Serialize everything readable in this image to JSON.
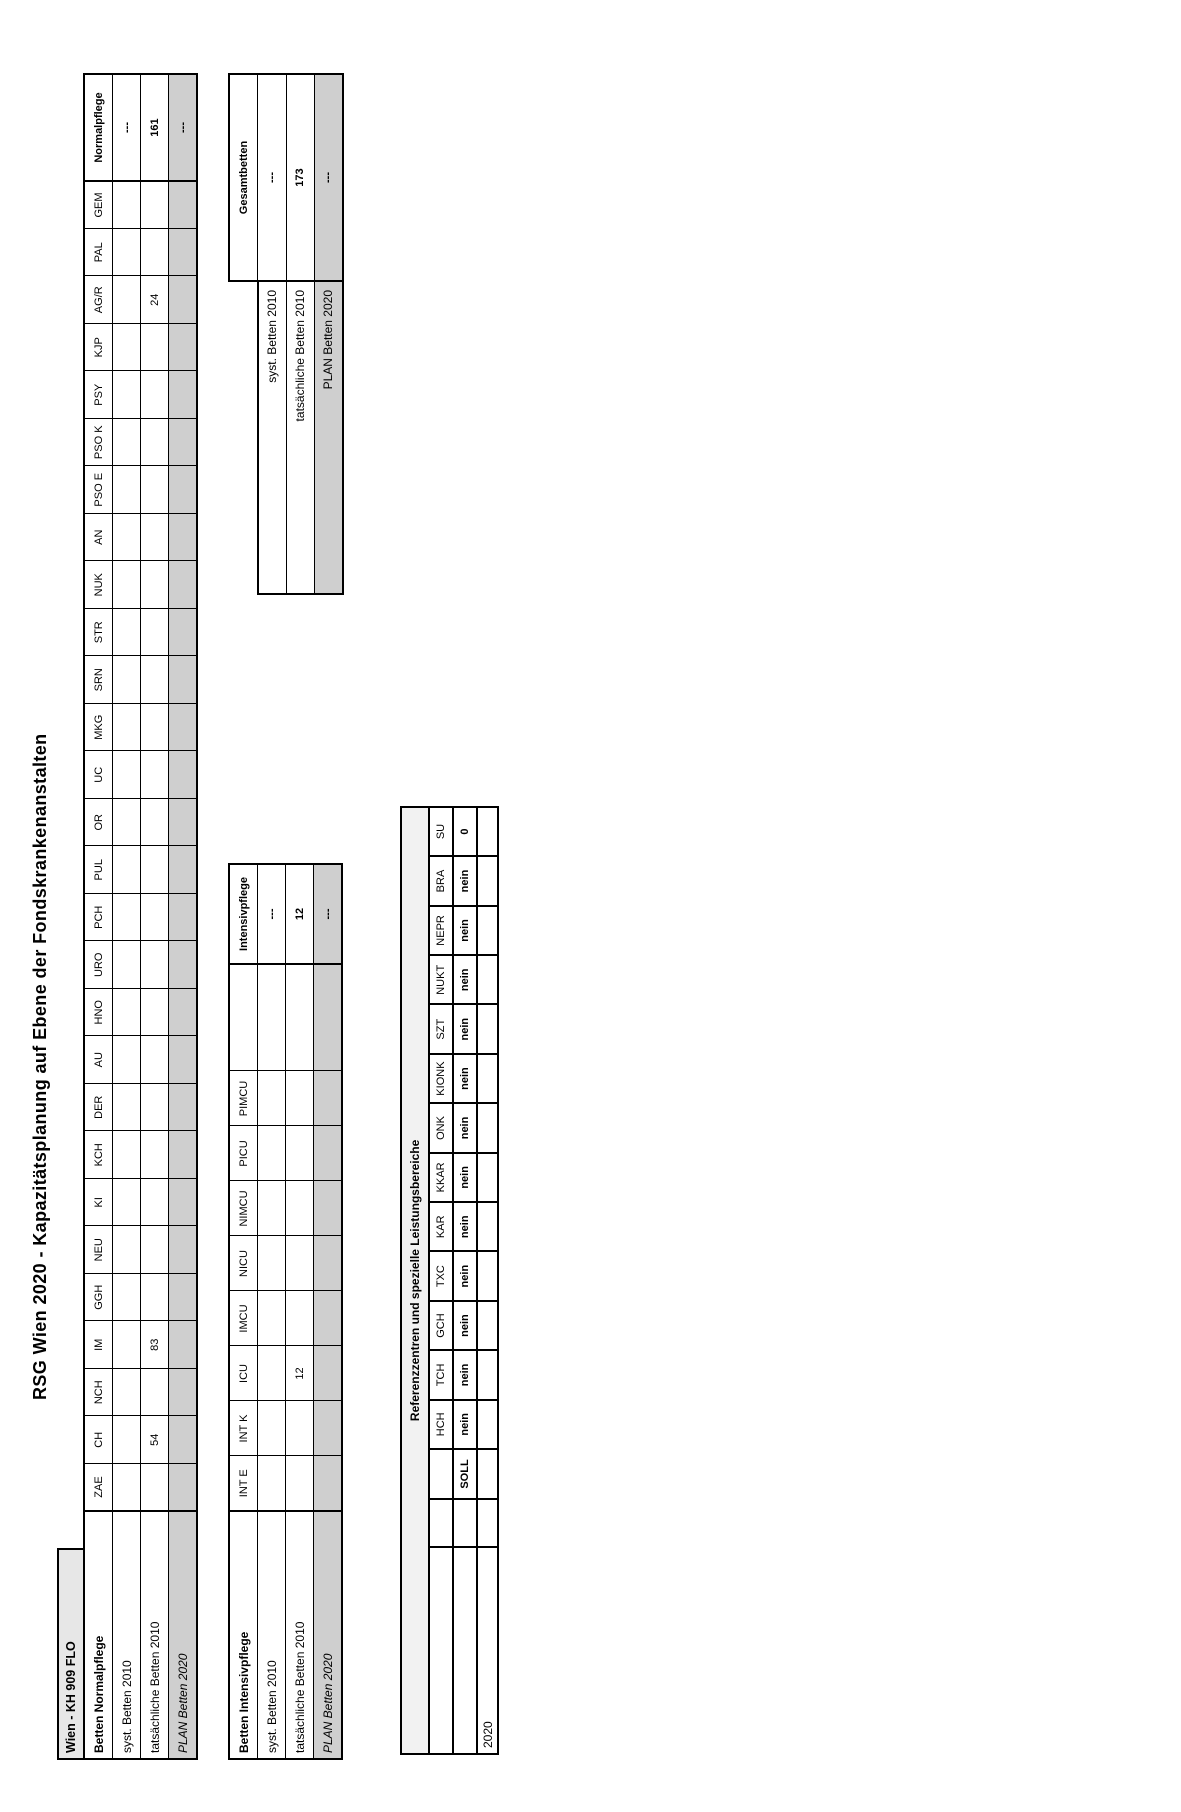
{
  "title": "RSG Wien 2020 - Kapazitätsplanung auf Ebene der Fondskrankenanstalten",
  "facility": "Wien - KH 909 FLO",
  "tables": {
    "normalpflege": {
      "row_label_header": "Betten Normalpflege",
      "sum_column": "Normalpflege",
      "columns": [
        "ZAE",
        "CH",
        "NCH",
        "IM",
        "GGH",
        "NEU",
        "KI",
        "KCH",
        "DER",
        "AU",
        "HNO",
        "URO",
        "PCH",
        "PUL",
        "OR",
        "UC",
        "MKG",
        "SRN",
        "STR",
        "NUK",
        "AN",
        "PSO E",
        "PSO K",
        "PSY",
        "KJP",
        "AG/R",
        "PAL",
        "GEM"
      ],
      "rows": [
        {
          "label": "syst. Betten 2010",
          "style": "normal",
          "values": {},
          "sum": "---"
        },
        {
          "label": "tatsächliche Betten 2010",
          "style": "normal",
          "values": {
            "CH": "54",
            "IM": "83",
            "AG/R": "24"
          },
          "sum": "161"
        },
        {
          "label": "PLAN Betten 2020",
          "style": "plan",
          "values": {},
          "sum": "---"
        }
      ]
    },
    "intensivpflege": {
      "row_label_header": "Betten Intensivpflege",
      "sum_column": "Intensivpflege",
      "columns": [
        "INT E",
        "INT K",
        "ICU",
        "IMCU",
        "NICU",
        "NIMCU",
        "PICU",
        "PIMCU"
      ],
      "rows": [
        {
          "label": "syst. Betten 2010",
          "style": "normal",
          "values": {},
          "sum": "---"
        },
        {
          "label": "tatsächliche Betten 2010",
          "style": "normal",
          "values": {
            "ICU": "12"
          },
          "sum": "12"
        },
        {
          "label": "PLAN Betten 2020",
          "style": "plan",
          "values": {},
          "sum": "---"
        }
      ]
    },
    "gesamtbetten": {
      "header": "Gesamtbetten",
      "rows": [
        {
          "label": "syst. Betten 2010",
          "style": "normal",
          "value": "---"
        },
        {
          "label": "tatsächliche Betten 2010",
          "style": "normal",
          "value": "173"
        },
        {
          "label": "PLAN Betten 2020",
          "style": "plan",
          "value": "---"
        }
      ]
    },
    "referenzzentren": {
      "header": "Referenzzentren und spezielle Leistungsbereiche",
      "columns": [
        "HCH",
        "TCH",
        "GCH",
        "TXC",
        "KAR",
        "KKAR",
        "ONK",
        "KIONK",
        "SZT",
        "NUKT",
        "NEPR",
        "BRA",
        "SU"
      ],
      "rows": [
        {
          "label": "SOLL",
          "values": [
            "nein",
            "nein",
            "nein",
            "nein",
            "nein",
            "nein",
            "nein",
            "nein",
            "nein",
            "nein",
            "nein",
            "nein",
            "0"
          ]
        },
        {
          "label": "2020",
          "values": [
            "",
            "",
            "",
            "",
            "",
            "",
            "",
            "",
            "",
            "",
            "",
            "",
            ""
          ]
        }
      ]
    }
  }
}
